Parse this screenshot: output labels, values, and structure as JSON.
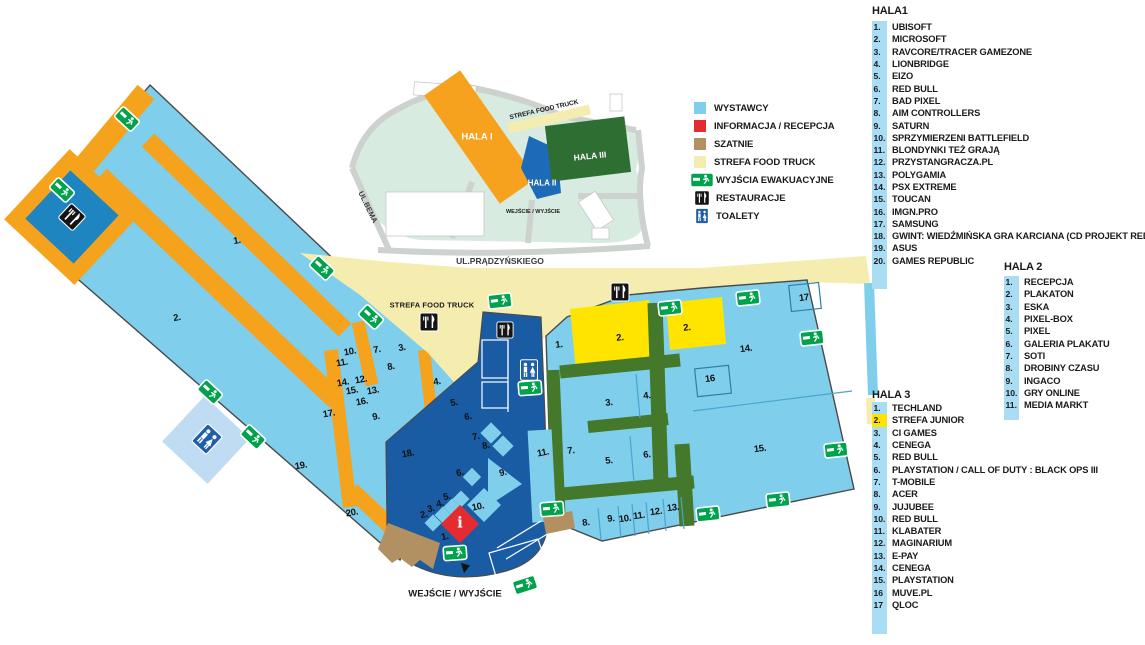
{
  "legend": {
    "items": [
      {
        "label": "WYSTAWCY",
        "swatch": "exhibitor"
      },
      {
        "label": "INFORMACJA / RECEPCJA",
        "swatch": "info"
      },
      {
        "label": "SZATNIE",
        "swatch": "szatnie"
      },
      {
        "label": "STREFA FOOD TRUCK",
        "swatch": "food"
      },
      {
        "label": "WYJŚCIA EWAKUACYJNE",
        "swatch": "exit-icon"
      },
      {
        "label": "RESTAURACJE",
        "swatch": "restaurant-icon"
      },
      {
        "label": "TOALETY",
        "swatch": "toilet-icon"
      }
    ]
  },
  "halls": {
    "hala1": {
      "title": "HALA1",
      "items": [
        {
          "n": "1.",
          "label": "UBISOFT"
        },
        {
          "n": "2.",
          "label": "MICROSOFT"
        },
        {
          "n": "3.",
          "label": "RAVCORE/TRACER GAMEZONE"
        },
        {
          "n": "4.",
          "label": "LIONBRIDGE"
        },
        {
          "n": "5.",
          "label": "EIZO"
        },
        {
          "n": "6.",
          "label": "RED BULL"
        },
        {
          "n": "7.",
          "label": "BAD PIXEL"
        },
        {
          "n": "8.",
          "label": "AIM CONTROLLERS"
        },
        {
          "n": "9.",
          "label": "SATURN"
        },
        {
          "n": "10.",
          "label": "SPRZYMIERZENI BATTLEFIELD"
        },
        {
          "n": "11.",
          "label": "BLONDYNKI TEŻ GRAJĄ"
        },
        {
          "n": "12.",
          "label": "PRZYSTANGRACZA.PL"
        },
        {
          "n": "13.",
          "label": "POLYGAMIA"
        },
        {
          "n": "14.",
          "label": "PSX EXTREME"
        },
        {
          "n": "15.",
          "label": "TOUCAN"
        },
        {
          "n": "16.",
          "label": "IMGN.PRO"
        },
        {
          "n": "17.",
          "label": "SAMSUNG"
        },
        {
          "n": "18.",
          "label": "GWINT: WIEDŹMIŃSKA GRA KARCIANA (CD PROJEKT RED)"
        },
        {
          "n": "19.",
          "label": "ASUS"
        },
        {
          "n": "20.",
          "label": "GAMES REPUBLIC"
        }
      ]
    },
    "hala2": {
      "title": "HALA 2",
      "items": [
        {
          "n": "1.",
          "label": "RECEPCJA"
        },
        {
          "n": "2.",
          "label": "PLAKATON"
        },
        {
          "n": "3.",
          "label": "ESKA"
        },
        {
          "n": "4.",
          "label": "PIXEL-BOX"
        },
        {
          "n": "5.",
          "label": "PIXEL"
        },
        {
          "n": "6.",
          "label": "GALERIA PLAKATU"
        },
        {
          "n": "7.",
          "label": "SOTI"
        },
        {
          "n": "8.",
          "label": "DROBINY CZASU"
        },
        {
          "n": "9.",
          "label": "INGACO"
        },
        {
          "n": "10.",
          "label": "GRY ONLINE"
        },
        {
          "n": "11.",
          "label": "MEDIA MARKT"
        }
      ]
    },
    "hala3": {
      "title": "HALA 3",
      "items": [
        {
          "n": "1.",
          "label": "TECHLAND"
        },
        {
          "n": "2.",
          "label": "STREFA JUNIOR",
          "chip": "yellow"
        },
        {
          "n": "3.",
          "label": "CI GAMES"
        },
        {
          "n": "4.",
          "label": "CENEGA"
        },
        {
          "n": "5.",
          "label": "RED BULL"
        },
        {
          "n": "6.",
          "label": "PLAYSTATION / CALL OF DUTY : BLACK OPS III"
        },
        {
          "n": "7.",
          "label": "T-MOBILE"
        },
        {
          "n": "8.",
          "label": "ACER"
        },
        {
          "n": "9.",
          "label": "JUJUBEE"
        },
        {
          "n": "10.",
          "label": "RED BULL"
        },
        {
          "n": "11.",
          "label": "KLABATER"
        },
        {
          "n": "12.",
          "label": "MAGINARIUM"
        },
        {
          "n": "13.",
          "label": "E-PAY"
        },
        {
          "n": "14.",
          "label": "CENEGA"
        },
        {
          "n": "15.",
          "label": "PLAYSTATION"
        },
        {
          "n": "16",
          "label": "MUVE.PL"
        },
        {
          "n": "17",
          "label": "QLOC"
        }
      ]
    }
  },
  "overview": {
    "hala_i": "HALA I",
    "hala_ii": "HALA II",
    "hala_iii": "HALA III",
    "food": "STREFA FOOD TRUCK",
    "entrance": "WEJŚCIE / WYJŚCIE",
    "street_bema": "UL.BEMA",
    "street_pradzynskiego": "UL.PRĄDZYŃSKIEGO"
  },
  "map": {
    "food_zone_label": "STREFA FOOD TRUCK",
    "entrance_label": "WEJŚCIE / WYJŚCIE",
    "info_symbol": "i"
  },
  "colors": {
    "exhibitor_blue": "#7FCEEC",
    "chip_blue": "#A9DDF3",
    "info_red": "#E62B30",
    "szatnie_brown": "#B39062",
    "food_yellow": "#F5EDB0",
    "junior_yellow": "#FFE400",
    "exit_green": "#00A24C",
    "hala2_blue": "#1A5CA4",
    "aisle_green": "#44782A",
    "corridor_orange": "#F5A21D",
    "overview_hala1_orange": "#F6A21E",
    "overview_hala2_blue": "#1D6AB8",
    "overview_hala3_green": "#2F6E33",
    "campus_mint": "#D8EBE0",
    "annex_blue": "#BFDCF2",
    "restaurant_black": "#151515",
    "toilet_blue": "#1E5FA8"
  }
}
